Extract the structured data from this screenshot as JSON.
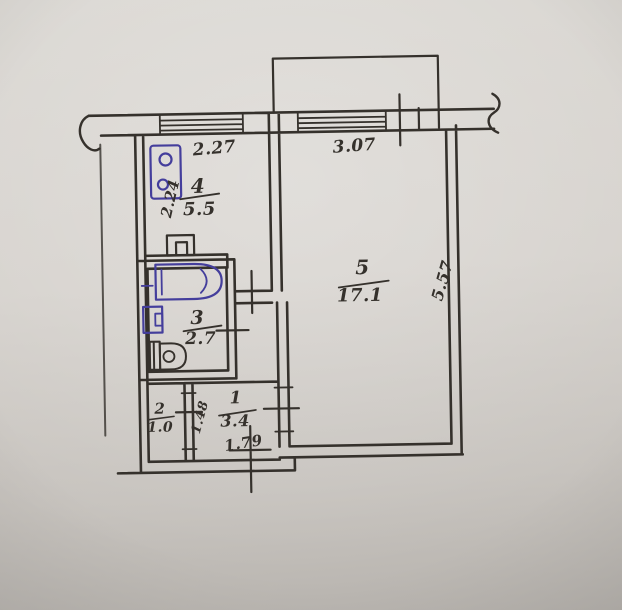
{
  "plan": {
    "rooms": [
      {
        "number": "1",
        "area": "3.4"
      },
      {
        "number": "2",
        "area": "1.0"
      },
      {
        "number": "3",
        "area": "2.7"
      },
      {
        "number": "4",
        "area": "5.5"
      },
      {
        "number": "5",
        "area": "17.1"
      }
    ],
    "dims": {
      "room4_width": "2.27",
      "room5_width": "3.07",
      "room4_depth": "2.24",
      "room5_depth": "5.57",
      "room2_depth": "1.48",
      "hall_width": "1.79"
    },
    "colors": {
      "ink": "#35312c",
      "fixture_ink": "#443e9c",
      "paper": "#d6d2cd"
    }
  }
}
